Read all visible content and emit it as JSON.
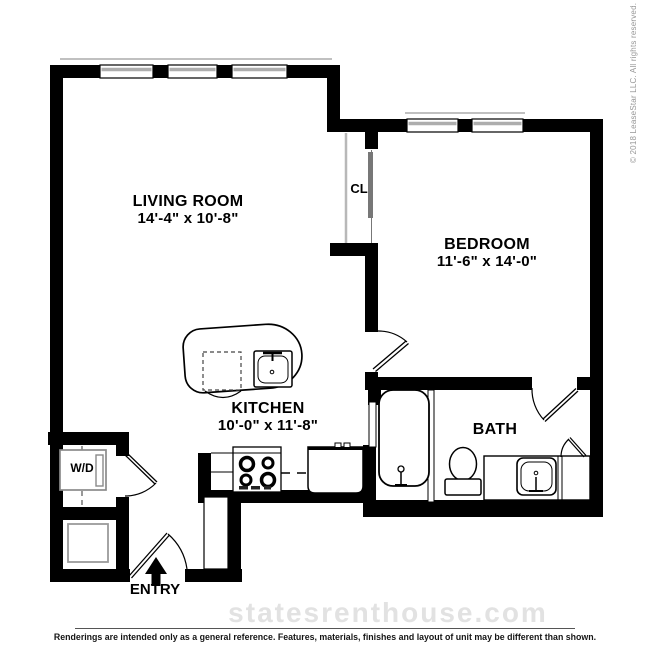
{
  "floorplan": {
    "rooms": [
      {
        "name": "LIVING ROOM",
        "dims": "14'-4\" x 10'-8\""
      },
      {
        "name": "BEDROOM",
        "dims": "11'-6\" x 14'-0\""
      },
      {
        "name": "KITCHEN",
        "dims": "10'-0\" x 11'-8\""
      },
      {
        "name": "BATH"
      },
      {
        "name": "CL"
      },
      {
        "name": "W/D"
      },
      {
        "name": "ENTRY"
      }
    ]
  },
  "watermark": "statesrenthouse.com",
  "copyright": "© 2018 LeaseStar LLC. All rights reserved.",
  "disclaimer": "Renderings are intended only as a general reference. Features, materials, finishes and layout of unit may be different than shown.",
  "colors": {
    "wall": "#000000",
    "fixture_outline": "#8a8a8a",
    "window_gray": "#adadad",
    "watermark_gray": "#e2e2e2",
    "copyright_gray": "#979797"
  }
}
